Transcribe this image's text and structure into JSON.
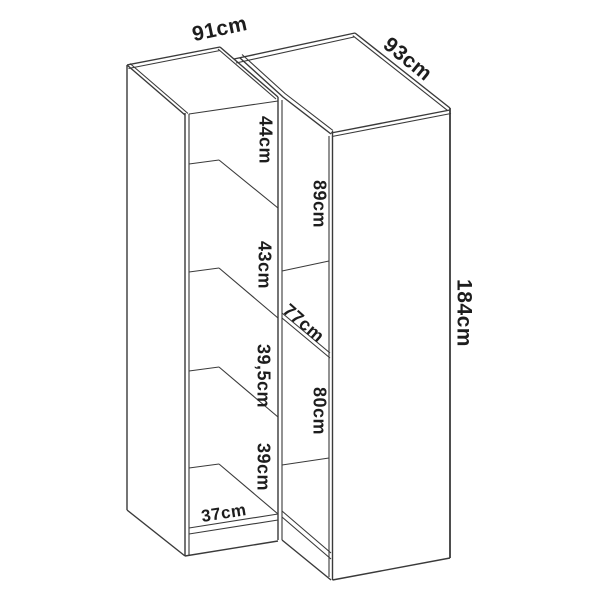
{
  "diagram": {
    "subject": "corner-wardrobe-dimension-diagram",
    "unit": "cm",
    "labels": {
      "left_unit_width": "91cm",
      "corner_unit_side": "93cm",
      "overall_height": "184cm",
      "corner_upper_height": "89cm",
      "corner_diagonal_width": "77cm",
      "corner_lower_height": "80cm",
      "compartment_1_height": "44cm",
      "compartment_2_height": "43cm",
      "compartment_3_height": "39,5cm",
      "compartment_4_height": "39cm",
      "base_depth": "37cm"
    },
    "colors": {
      "line": "#3a3a3a",
      "text": "#1d1d1d",
      "background": "#ffffff"
    }
  }
}
